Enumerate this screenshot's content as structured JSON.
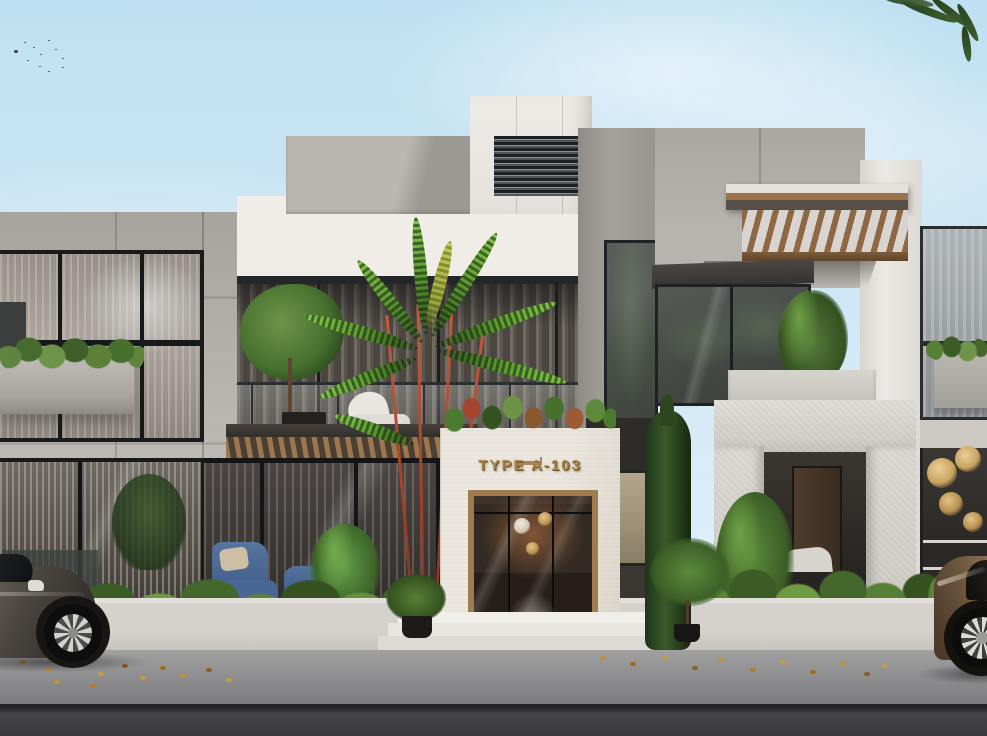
{
  "image": {
    "kind": "architectural-exterior-rendering",
    "description": "Daylight street-view rendering of a modern two-storey townhouse facade in grey concrete and white stone, with a central glass entrance labelled TYPE A-103, timber pergolas, balcony planting, a red-stem palm, clipped shrubs, a cypress, fallen leaves on the pavement and two partially visible parked cars."
  },
  "entrance": {
    "sign_label": "TYPE A-103"
  },
  "palette": {
    "sky_top": "#bfe0f2",
    "sky_bottom": "#e6f3fb",
    "concrete": "#a7a39e",
    "concrete_light": "#bdb9b4",
    "white_wall": "#f0ede8",
    "stone": "#e1ddd7",
    "frame_dark": "#1d1f20",
    "glass_dark": "#4b4f4d",
    "glass_light": "#a2a6a7",
    "wood": "#9a734a",
    "gold": "#a8854e",
    "leaf": "#5b8437",
    "leaf_dark": "#2f4a24",
    "palm_stem_red": "#9c3d27",
    "curb": "#d5d2cd",
    "pavement": "#858587",
    "road": "#39393c",
    "chair_blue": "#44608c",
    "car_left": "#4a453f",
    "car_right": "#6e573f",
    "autumn_leaf": "#c49038"
  },
  "scene": {
    "sky": "clear light-blue sky with soft clouds",
    "birds": "small flock of birds, upper left",
    "sections": {
      "left_wing": "grey concrete unit, two glazed floors, facade planter box",
      "center_unit": "white unit with recessed first-floor balcony, glass railing, timber pergola over ground-floor patio",
      "roof_tower": "white parapet volume with dark louvre vent",
      "entrance": "white stone portal, gold unit lettering, timber-framed glass door with pendant lights inside",
      "right_wing": "grey unit with timber slat pergola, corner glazing, recessed stone porch with bench",
      "far_right_unit": "edge of adjacent unit with window planter and chandelier window"
    },
    "landscape": "clipped shrub beds, columnar cypress, red-stem palm, potted plants, fallen autumn leaves",
    "vehicles": {
      "left": "dark grey car, partially in frame",
      "right": "bronze car, partially in frame"
    }
  }
}
